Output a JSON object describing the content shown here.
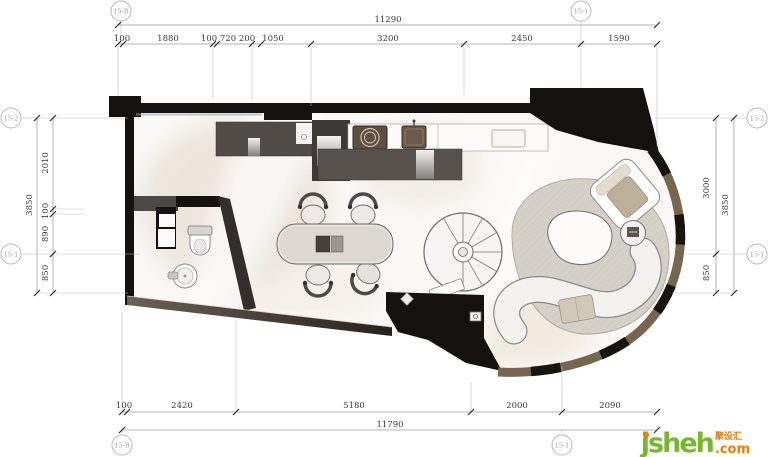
{
  "dimensions": {
    "top": {
      "total": "11290",
      "segments": [
        "100",
        "1880",
        "100",
        "720",
        "200",
        "1050",
        "3200",
        "2450",
        "1590"
      ]
    },
    "bottom": {
      "total": "11790",
      "segments": [
        "100",
        "2420",
        "5180",
        "2000",
        "2090"
      ]
    },
    "left": {
      "total": "3850",
      "segments": [
        "2010",
        "100",
        "890",
        "850"
      ]
    },
    "right": {
      "total": "3850",
      "segments": [
        "3000",
        "850"
      ]
    }
  },
  "axis_markers": {
    "top_left": "15-B",
    "top_right": "15-1",
    "bottom_left": "15-B",
    "bottom_right": "15-1",
    "left_top": "15-2",
    "left_bottom": "15-1",
    "right_top": "15-2",
    "right_bottom": "15-1"
  },
  "watermark": {
    "brand": "jsheh",
    "tld": ".com",
    "cn": "聚设汇"
  },
  "colors": {
    "wall": "#14110f",
    "curtain_wall": "#77664f",
    "cabinet_gray": "#57524e",
    "rug": "#d6d1c8",
    "watermark_green": "#76b82a",
    "watermark_orange": "#f07c00"
  }
}
